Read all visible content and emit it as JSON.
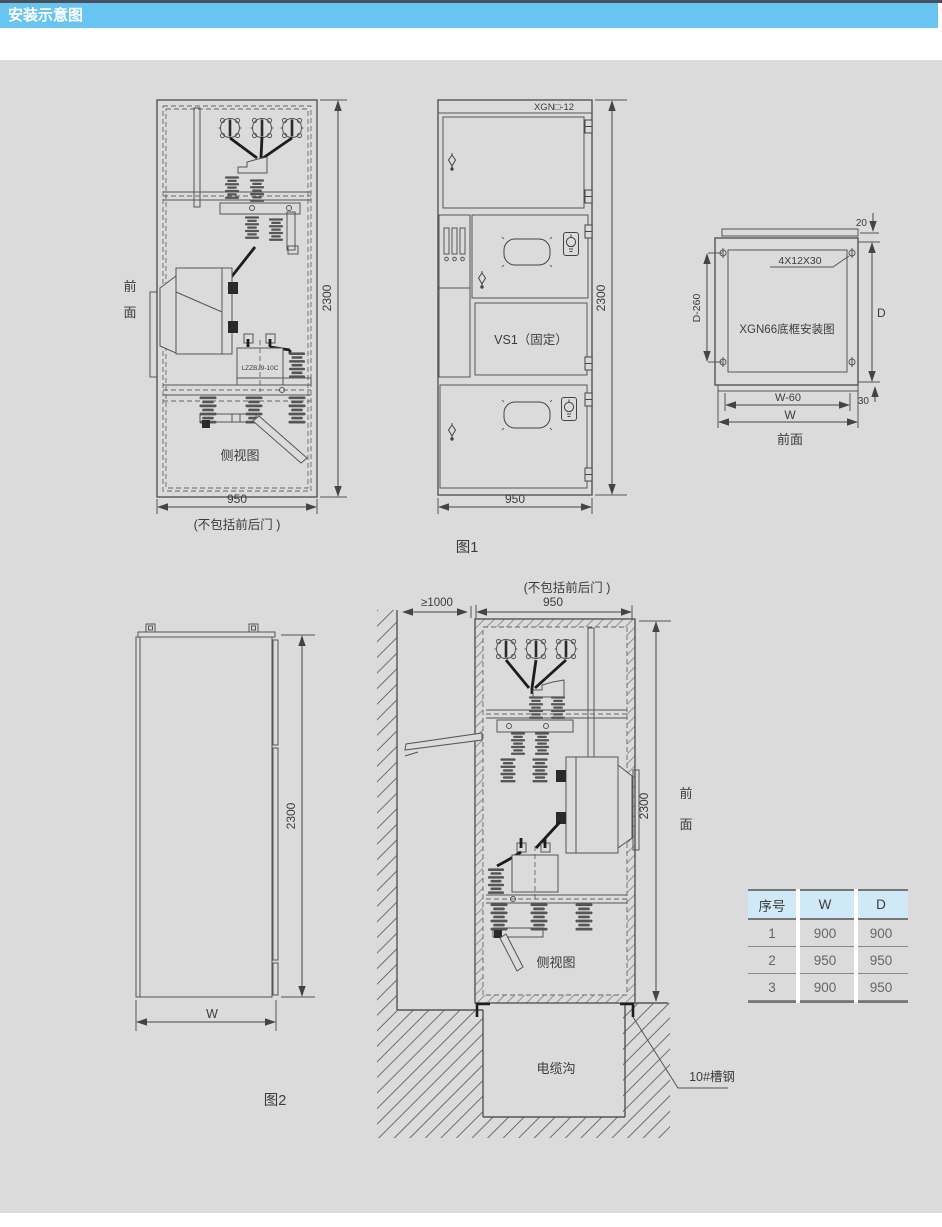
{
  "header": {
    "title": "安装示意图"
  },
  "colors": {
    "title_bar": "#68c4f0",
    "top_strip": "#46525e",
    "canvas_bg": "#dbdbdb",
    "table_header_bg": "#cfe9f7",
    "line": "#555555"
  },
  "fig1": {
    "front_top": "前",
    "front_bottom": "面",
    "side_view_label": "侧视图",
    "ct_label": "LZZBJ9-10C",
    "dim_height": "2300",
    "dim_width": "950",
    "door_note": "(不包括前后门 )",
    "model": "XGN□-12",
    "vs1_label": "VS1（固定）",
    "dim_height_front": "2300",
    "dim_width_front": "950",
    "caption": "图1"
  },
  "frame": {
    "title": "XGN66底框安装图",
    "bolt_label": "4X12X30",
    "dim_top": "20",
    "dim_bottom": "30",
    "dim_left": "D-260",
    "dim_right": "D",
    "dim_w60": "W-60",
    "dim_w": "W",
    "caption": "前面"
  },
  "fig2": {
    "dim_height": "2300",
    "dim_width": "W",
    "caption": "图2"
  },
  "inst": {
    "clearance": "≥1000",
    "door_note": "(不包括前后门 )",
    "dim_width": "950",
    "dim_height": "2300",
    "front_top": "前",
    "front_bottom": "面",
    "side_view_label": "侧视图",
    "trench_label": "电缆沟",
    "channel_label": "10#槽钢"
  },
  "table": {
    "headers": [
      "序号",
      "W",
      "D"
    ],
    "rows": [
      [
        "1",
        "900",
        "900"
      ],
      [
        "2",
        "950",
        "950"
      ],
      [
        "3",
        "900",
        "950"
      ]
    ]
  }
}
